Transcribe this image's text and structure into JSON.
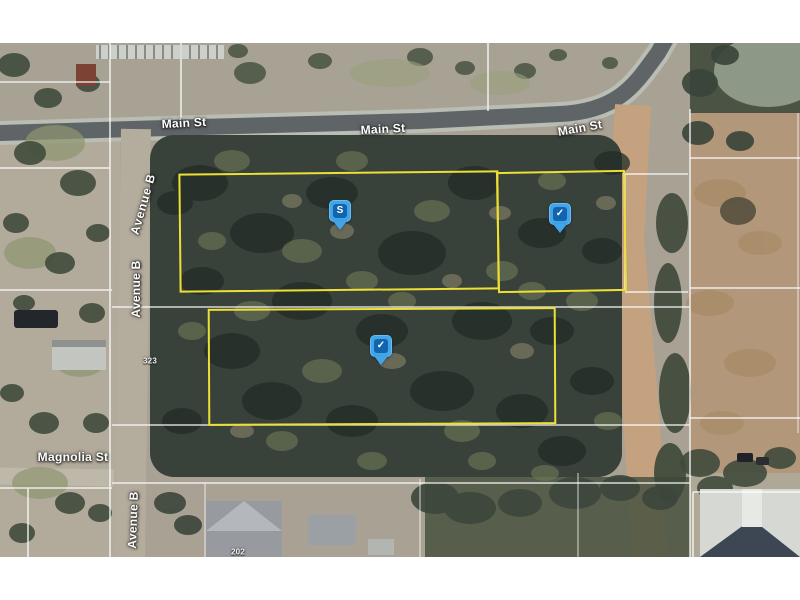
{
  "map": {
    "street_labels": [
      {
        "id": "main-st-west",
        "text": "Main St"
      },
      {
        "id": "main-st-center",
        "text": "Main St"
      },
      {
        "id": "main-st-east",
        "text": "Main St"
      },
      {
        "id": "avenue-b-north",
        "text": "Avenue B"
      },
      {
        "id": "avenue-b-mid",
        "text": "Avenue B"
      },
      {
        "id": "avenue-b-south",
        "text": "Avenue B"
      },
      {
        "id": "magnolia-st",
        "text": "Magnolia St"
      }
    ],
    "address_labels": [
      {
        "id": "addr-323",
        "text": "323"
      },
      {
        "id": "addr-202",
        "text": "202"
      }
    ],
    "markers": [
      {
        "id": "marker-s",
        "glyph": "S"
      },
      {
        "id": "marker-check-east",
        "glyph": "✓"
      },
      {
        "id": "marker-check-south",
        "glyph": "✓"
      }
    ],
    "parcels": [
      {
        "id": "parcel-northwest"
      },
      {
        "id": "parcel-northeast"
      },
      {
        "id": "parcel-south"
      }
    ],
    "colors": {
      "parcel_outline": "#ecdf38",
      "marker_fill": "#41a5e8",
      "marker_badge": "#1264ae",
      "label_text": "#ffffff",
      "background": "#ffffff"
    }
  }
}
